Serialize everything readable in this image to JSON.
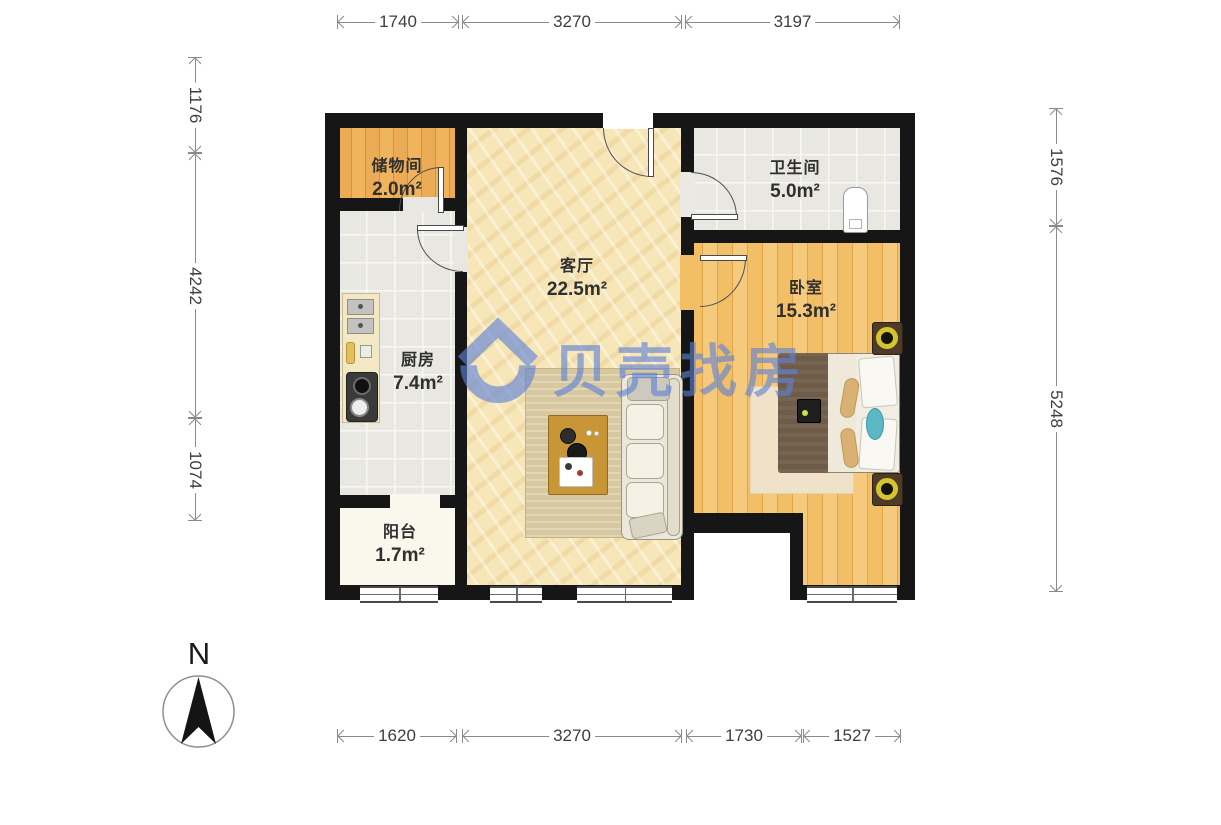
{
  "meta": {
    "type": "residential-floor-plan",
    "palette": {
      "wall": "#161616",
      "watermark_blue": "#5E82D8",
      "wood_floor": "#F0BC60",
      "storage_floor": "#EBA94F",
      "living_floor": "#F6E6B8",
      "tile_floor": "#E8E7E2",
      "balcony_floor": "#FAF8EC"
    }
  },
  "watermark": {
    "brand": "贝壳找房",
    "logo": "beike-house-logo",
    "color": "#5E82D8"
  },
  "compass": {
    "north_label": "N"
  },
  "rooms": {
    "storage": {
      "name": "储物间",
      "area": "2.0m²"
    },
    "bathroom": {
      "name": "卫生间",
      "area": "5.0m²"
    },
    "living": {
      "name": "客厅",
      "area": "22.5m²"
    },
    "bedroom": {
      "name": "卧室",
      "area": "15.3m²"
    },
    "kitchen": {
      "name": "厨房",
      "area": "7.4m²"
    },
    "balcony": {
      "name": "阳台",
      "area": "1.7m²"
    }
  },
  "dimensions": {
    "top": [
      "1740",
      "3270",
      "3197"
    ],
    "bottom": [
      "1620",
      "3270",
      "1730",
      "1527"
    ],
    "left": [
      "1176",
      "4242",
      "1074"
    ],
    "right": [
      "1576",
      "5248"
    ]
  }
}
